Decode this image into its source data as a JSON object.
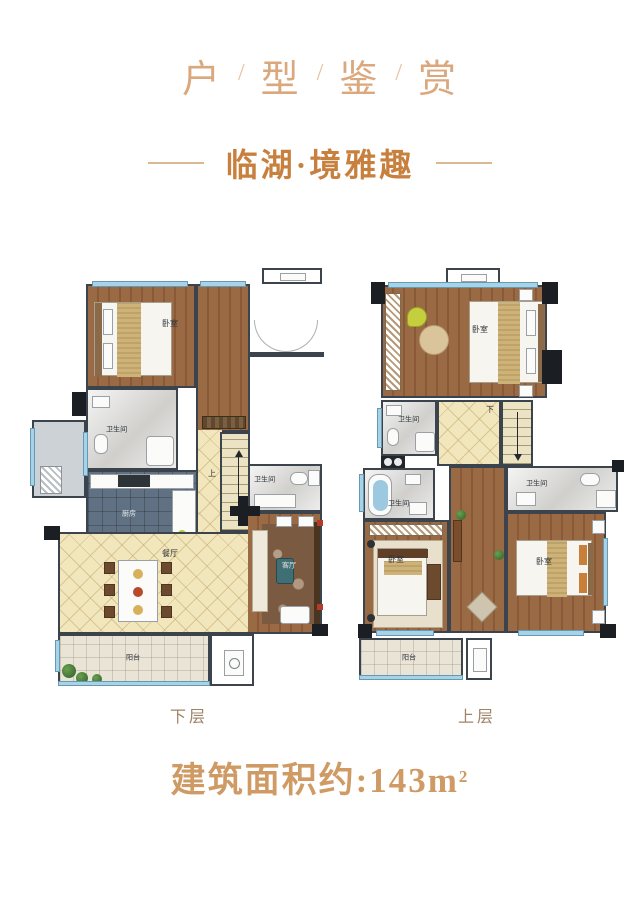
{
  "header": {
    "title_chars": [
      "户",
      "型",
      "鉴",
      "赏"
    ],
    "slash": "/",
    "subtitle": "临湖·境雅趣"
  },
  "plan_lower": {
    "caption": "下层",
    "rooms": {
      "bedroom": "卧室",
      "bathroom1": "卫生间",
      "kitchen": "厨房",
      "dining": "餐厅",
      "living": "客厅",
      "bathroom2": "卫生间",
      "balcony": "阳台",
      "stairs": "上"
    }
  },
  "plan_upper": {
    "caption": "上层",
    "rooms": {
      "bedroom_master": "卧室",
      "bathroom1": "卫生间",
      "bathroom2": "卫生间",
      "bathroom3": "卫生间",
      "bedroom_left": "卧室",
      "bedroom_right": "卧室",
      "balcony": "阳台",
      "stairs": "下"
    }
  },
  "footer": {
    "area_text": "建筑面积约:143m",
    "area_sup": "2"
  },
  "colors": {
    "accent_title": "#dba77c",
    "accent_subtitle": "#c8803f",
    "accent_footer": "#cf9a63",
    "caption": "#a08467",
    "wall_dark": "#3b434c",
    "window_blue": "#a8d2e5",
    "floor_wood": "#9a6a44",
    "floor_beige": "#f2e6bc",
    "floor_marble": "#dcdbd8",
    "floor_kitchen": "#5f7182",
    "floor_balcony": "#eae4d7"
  }
}
